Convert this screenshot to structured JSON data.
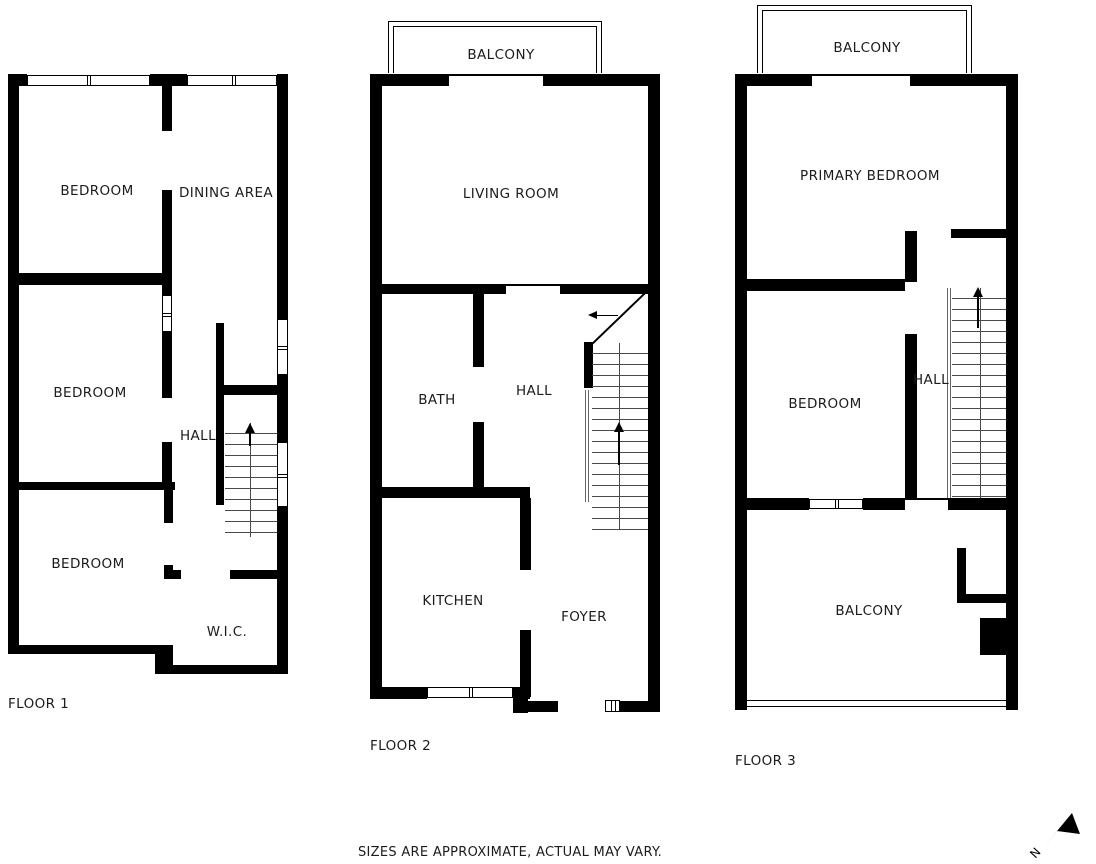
{
  "floors": [
    {
      "label": "FLOOR 1",
      "rooms": {
        "bedroom_front": "BEDROOM",
        "dining": "DINING AREA",
        "bedroom_middle": "BEDROOM",
        "hall": "HALL",
        "bedroom_back": "BEDROOM",
        "wic": "W.I.C."
      }
    },
    {
      "label": "FLOOR 2",
      "rooms": {
        "balcony": "BALCONY",
        "living_room": "LIVING ROOM",
        "bath": "BATH",
        "hall": "HALL",
        "kitchen": "KITCHEN",
        "foyer": "FOYER"
      }
    },
    {
      "label": "FLOOR 3",
      "rooms": {
        "balcony_front": "BALCONY",
        "primary_bedroom": "PRIMARY BEDROOM",
        "bedroom": "BEDROOM",
        "hall": "HALL",
        "balcony_rear": "BALCONY"
      }
    }
  ],
  "footer": {
    "disclaimer": "SIZES ARE APPROXIMATE, ACTUAL MAY VARY."
  },
  "compass": {
    "label": "N"
  },
  "colors": {
    "wall": "#000000",
    "text": "#1c1c1c",
    "background": "#ffffff",
    "stair_line": "#4a4a4a"
  }
}
